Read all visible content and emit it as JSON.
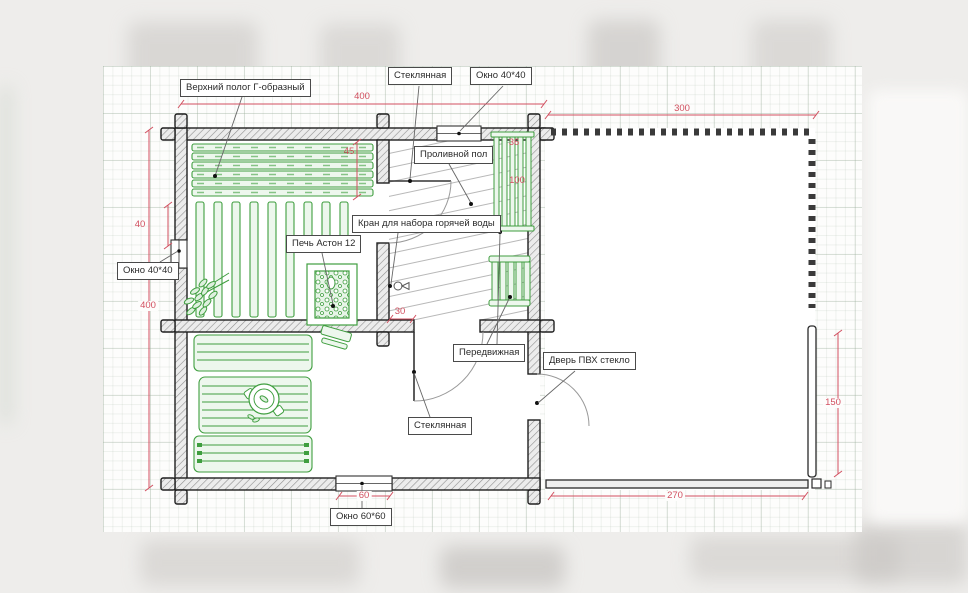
{
  "plan": {
    "title_hint": "sauna floor plan",
    "labels": [
      {
        "id": "upper-shelf",
        "text": "Верхний полог Г-образный"
      },
      {
        "id": "glass-door-top",
        "text": "Стеклянная"
      },
      {
        "id": "window-top",
        "text": "Окно 40*40"
      },
      {
        "id": "pouring-floor",
        "text": "Проливной пол"
      },
      {
        "id": "hot-water-tap",
        "text": "Кран для набора горячей воды"
      },
      {
        "id": "stove",
        "text": "Печь Астон 12"
      },
      {
        "id": "window-left",
        "text": "Окно 40*40"
      },
      {
        "id": "movable-bench",
        "text": "Передвижная"
      },
      {
        "id": "pvc-door",
        "text": "Дверь ПВХ стекло"
      },
      {
        "id": "glass-door-bottom",
        "text": "Стеклянная"
      },
      {
        "id": "window-bottom",
        "text": "Окно 60*60"
      }
    ],
    "dimensions": [
      {
        "id": "top-width",
        "value": "400"
      },
      {
        "id": "terrace-width",
        "value": "300"
      },
      {
        "id": "bench-depth",
        "value": "45"
      },
      {
        "id": "wash-bench-width",
        "value": "36"
      },
      {
        "id": "wash-bench-length",
        "value": "100"
      },
      {
        "id": "window-offset",
        "value": "40"
      },
      {
        "id": "left-height",
        "value": "400"
      },
      {
        "id": "door-offset",
        "value": "30"
      },
      {
        "id": "terrace-right",
        "value": "150"
      },
      {
        "id": "terrace-bottom",
        "value": "270"
      },
      {
        "id": "window-bottom-size",
        "value": "60"
      }
    ],
    "colors": {
      "dimension": "#d25060",
      "furniture": "#3f9e3f",
      "wall_outline": "#1f1f1f",
      "floor_hatch": "#b8b8b8"
    }
  }
}
